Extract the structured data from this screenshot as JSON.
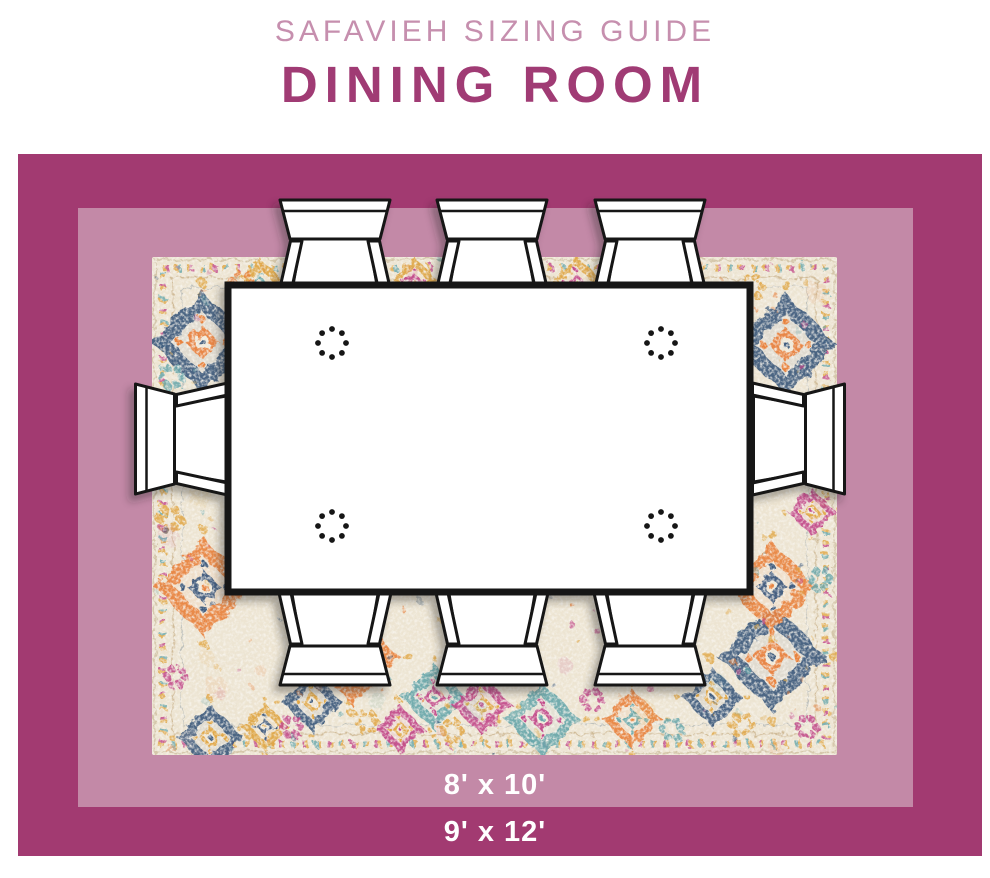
{
  "header": {
    "eyebrow": "SAFAVIEH SIZING GUIDE",
    "title": "DINING ROOM"
  },
  "diagram": {
    "inner_size_label": "8' x 10'",
    "outer_size_label": "9' x 12'",
    "scene": {
      "chairs": 8,
      "place_settings": 4,
      "table_shape": "rectangle"
    },
    "colors": {
      "outer": "#a23a71",
      "inner": "#c389a7",
      "eyebrow": "#c68fae",
      "title": "#a03b74",
      "label_text": "#ffffff",
      "rug_cream": "#ede5d3",
      "navy": "#3d5a7d",
      "orange": "#e8823e",
      "gold": "#e0a644",
      "teal": "#68a7ab",
      "magenta": "#c2498a",
      "outline": "#161616"
    }
  }
}
